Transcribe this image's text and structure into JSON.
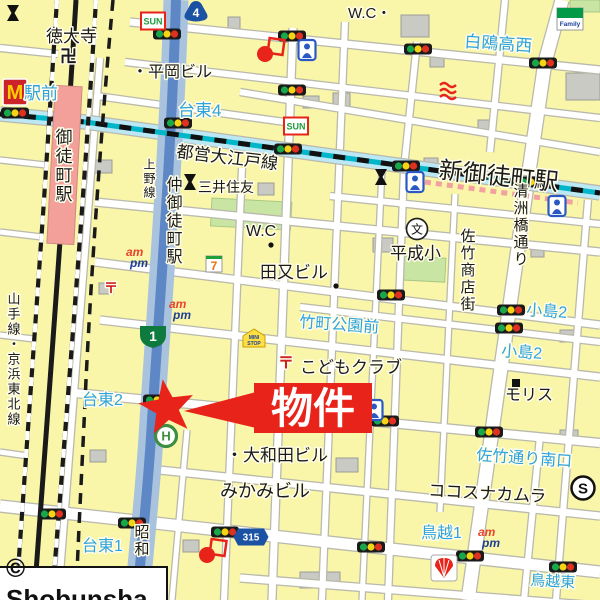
{
  "copyright": "© Shobunsha",
  "property_marker": {
    "label": "物件",
    "star": {
      "x": 167,
      "y": 408,
      "outer": 29,
      "inner": 12
    },
    "banner": {
      "x": 254,
      "y": 383,
      "w": 118,
      "h": 50
    },
    "pointer": [
      [
        256,
        392
      ],
      [
        256,
        428
      ],
      [
        184,
        411
      ]
    ]
  },
  "colors": {
    "block": "#FAF6A9",
    "street": "#FFFFFF",
    "casing": "#B9B9AC",
    "road_blue_outer": "#A9C3DE",
    "road_blue_core": "#5E87C6",
    "road_cyan": "#BCE7F5",
    "oedo_teal": "#00B6C9",
    "station_band": "#F3A0A0",
    "park": "#C9E5A3",
    "building": "#C9CAC4",
    "building_edge": "#9B9C96",
    "label_blue": "#2FA3DC",
    "label_red": "#CC2222",
    "red": "#E8231A",
    "rail": "#1A1A1A",
    "station_pink": "#F2A099",
    "shield_blue": "#1B52A3",
    "shield_green": "#0E7A3E"
  },
  "map": {
    "parks": [
      [
        212,
        198,
        80,
        28,
        3
      ],
      [
        404,
        256,
        42,
        24,
        3
      ],
      [
        570,
        0,
        30,
        12,
        0
      ]
    ],
    "buildings": [
      [
        401,
        15,
        28,
        22
      ],
      [
        430,
        55,
        14,
        12
      ],
      [
        566,
        73,
        34,
        27
      ],
      [
        303,
        96,
        16,
        12
      ],
      [
        478,
        120,
        18,
        13
      ],
      [
        94,
        160,
        18,
        13
      ],
      [
        258,
        183,
        16,
        12
      ],
      [
        424,
        158,
        14,
        11
      ],
      [
        531,
        246,
        13,
        11
      ],
      [
        373,
        238,
        20,
        14
      ],
      [
        99,
        283,
        14,
        11
      ],
      [
        560,
        330,
        16,
        12
      ],
      [
        336,
        458,
        22,
        14
      ],
      [
        183,
        540,
        16,
        12
      ],
      [
        300,
        572,
        40,
        16
      ],
      [
        90,
        450,
        16,
        12
      ],
      [
        560,
        430,
        18,
        12
      ],
      [
        228,
        17,
        12,
        17
      ],
      [
        333,
        93,
        17,
        17
      ]
    ],
    "streets": [
      {
        "pts": [
          [
            130,
            22
          ],
          [
            600,
            70
          ]
        ],
        "w": 7
      },
      {
        "pts": [
          [
            125,
            62
          ],
          [
            600,
            118
          ]
        ],
        "w": 6
      },
      {
        "pts": [
          [
            240,
            92
          ],
          [
            600,
            152
          ]
        ],
        "w": 6
      },
      {
        "pts": [
          [
            97,
            96
          ],
          [
            292,
            123
          ]
        ],
        "w": 6
      },
      {
        "pts": [
          [
            330,
            196
          ],
          [
            600,
            224
          ]
        ],
        "w": 6
      },
      {
        "pts": [
          [
            95,
            202
          ],
          [
            600,
            252
          ]
        ],
        "w": 7
      },
      {
        "pts": [
          [
            95,
            262
          ],
          [
            600,
            325
          ]
        ],
        "w": 7
      },
      {
        "pts": [
          [
            300,
            307
          ],
          [
            600,
            342
          ]
        ],
        "w": 6
      },
      {
        "pts": [
          [
            100,
            320
          ],
          [
            600,
            377
          ]
        ],
        "w": 7
      },
      {
        "pts": [
          [
            75,
            393
          ],
          [
            600,
            443
          ]
        ],
        "w": 8
      },
      {
        "pts": [
          [
            140,
            468
          ],
          [
            600,
            516
          ]
        ],
        "w": 7
      },
      {
        "pts": [
          [
            0,
            506
          ],
          [
            600,
            572
          ]
        ],
        "w": 11
      },
      {
        "pts": [
          [
            240,
            578
          ],
          [
            600,
            606
          ]
        ],
        "w": 7
      },
      {
        "pts": [
          [
            0,
            48
          ],
          [
            58,
            54
          ]
        ],
        "w": 6
      },
      {
        "pts": [
          [
            0,
            160
          ],
          [
            46,
            165
          ]
        ],
        "w": 5
      },
      {
        "pts": [
          [
            0,
            232
          ],
          [
            42,
            237
          ]
        ],
        "w": 5
      },
      {
        "pts": [
          [
            0,
            335
          ],
          [
            34,
            339
          ]
        ],
        "w": 5
      },
      {
        "pts": [
          [
            0,
            452
          ],
          [
            28,
            456
          ]
        ],
        "w": 5
      },
      {
        "pts": [
          [
            100,
            58
          ],
          [
            58,
            600
          ]
        ],
        "w": 6
      },
      {
        "pts": [
          [
            242,
            168
          ],
          [
            224,
            600
          ]
        ],
        "w": 6
      },
      {
        "pts": [
          [
            293,
            28
          ],
          [
            272,
            600
          ]
        ],
        "w": 7
      },
      {
        "pts": [
          [
            345,
            22
          ],
          [
            322,
            600
          ]
        ],
        "w": 6
      },
      {
        "pts": [
          [
            417,
            42
          ],
          [
            404,
            168
          ],
          [
            388,
            600
          ]
        ],
        "w": 6
      },
      {
        "pts": [
          [
            382,
            170
          ],
          [
            362,
            600
          ]
        ],
        "w": 5
      },
      {
        "pts": [
          [
            455,
            194
          ],
          [
            440,
            512
          ]
        ],
        "w": 5
      },
      {
        "pts": [
          [
            562,
            0
          ],
          [
            545,
            62
          ],
          [
            527,
            185
          ],
          [
            468,
            600
          ]
        ],
        "w": 13
      },
      {
        "pts": [
          [
            588,
            200
          ],
          [
            556,
            600
          ]
        ],
        "w": 6
      },
      {
        "pts": [
          [
            505,
            0
          ],
          [
            490,
            152
          ]
        ],
        "w": 6
      },
      {
        "pts": [
          [
            540,
            436
          ],
          [
            524,
            600
          ]
        ],
        "w": 6
      },
      {
        "pts": [
          [
            187,
            430
          ],
          [
            172,
            600
          ]
        ],
        "w": 5
      }
    ],
    "showa_road_path": "M176,0 C172,140 160,300 152,420 C149,480 142,540 137,600",
    "kasuga_road_pts": [
      [
        0,
        114
      ],
      [
        85,
        122
      ],
      [
        600,
        193
      ]
    ],
    "oedo_station_band": [
      [
        425,
        176
      ],
      [
        578,
        197
      ]
    ],
    "railways": {
      "jr_hatched": [
        "M57,0 C45,200 28,420 16,600",
        "M96,0 C84,200 66,420 52,600"
      ],
      "jr_solid": "M76,0 C64,200 47,420 34,600",
      "underground_dashed": "M113,0 C102,120 92,260 86,380 C82,470 78,540 76,600"
    },
    "station_rect": {
      "x": 51,
      "y": 86,
      "w": 27,
      "h": 158,
      "rot": 3
    },
    "traffic_lights": [
      [
        15,
        113
      ],
      [
        167,
        34
      ],
      [
        178,
        123
      ],
      [
        292,
        36
      ],
      [
        292,
        90
      ],
      [
        288,
        149
      ],
      [
        418,
        49
      ],
      [
        543,
        63
      ],
      [
        406,
        166
      ],
      [
        531,
        182
      ],
      [
        391,
        295
      ],
      [
        511,
        310
      ],
      [
        509,
        328
      ],
      [
        157,
        400
      ],
      [
        233,
        408
      ],
      [
        385,
        421
      ],
      [
        489,
        432
      ],
      [
        52,
        514
      ],
      [
        132,
        523
      ],
      [
        225,
        532
      ],
      [
        371,
        547
      ],
      [
        470,
        556
      ],
      [
        563,
        567
      ]
    ],
    "shields": [
      {
        "name": "national-route-shield",
        "kind": "national",
        "label": "4",
        "x": 196,
        "y": 12
      },
      {
        "name": "expressway-route-shield",
        "kind": "shuto",
        "label": "1",
        "x": 153,
        "y": 336
      },
      {
        "name": "prefectural-route-shield",
        "kind": "pref",
        "label": "315",
        "x": 251,
        "y": 537
      }
    ],
    "icons": [
      {
        "name": "mcdonalds-icon",
        "kind": "mcdonalds",
        "x": 15,
        "y": 92,
        "label": "M"
      },
      {
        "name": "pachinko-sun-sign-icon",
        "kind": "sun",
        "x": 153,
        "y": 21,
        "label": "SUN"
      },
      {
        "name": "pachinko-sun-sign-icon",
        "kind": "sun",
        "x": 296,
        "y": 126,
        "label": "SUN"
      },
      {
        "name": "ampm-store-icon",
        "kind": "ampm",
        "x": 134,
        "y": 256,
        "label": "am pm"
      },
      {
        "name": "ampm-store-icon",
        "kind": "ampm",
        "x": 177,
        "y": 308,
        "label": "am pm"
      },
      {
        "name": "ampm-store-icon",
        "kind": "ampm",
        "x": 486,
        "y": 536,
        "label": "am pm"
      },
      {
        "name": "seven-eleven-icon",
        "kind": "seven",
        "x": 214,
        "y": 264,
        "label": "7"
      },
      {
        "name": "ministop-icon",
        "kind": "ministop",
        "x": 254,
        "y": 339,
        "label": "MINI STOP"
      },
      {
        "name": "familymart-icon",
        "kind": "familymart",
        "x": 570,
        "y": 19,
        "label": "Family"
      },
      {
        "name": "shell-gas-station-icon",
        "kind": "shell",
        "x": 444,
        "y": 568
      },
      {
        "name": "hibiya-line-entrance-icon",
        "kind": "hibiya",
        "x": 166,
        "y": 436,
        "label": "H"
      },
      {
        "name": "school-icon",
        "kind": "school",
        "x": 417,
        "y": 229,
        "label": "文"
      },
      {
        "name": "bank-icon",
        "kind": "bank",
        "x": 190,
        "y": 182
      },
      {
        "name": "bank-icon",
        "kind": "bank",
        "x": 381,
        "y": 177
      },
      {
        "name": "bank-icon",
        "kind": "bank",
        "x": 13,
        "y": 13
      },
      {
        "name": "supermarket-icon",
        "kind": "scircle",
        "x": 583,
        "y": 488,
        "label": "S"
      },
      {
        "name": "fire-station-icon",
        "kind": "fire",
        "x": 448,
        "y": 92
      },
      {
        "name": "police-box-icon",
        "kind": "koban",
        "x": 307,
        "y": 50
      },
      {
        "name": "police-box-icon",
        "kind": "koban",
        "x": 374,
        "y": 410
      },
      {
        "name": "subway-entrance-icon",
        "kind": "koban",
        "x": 415,
        "y": 182
      },
      {
        "name": "subway-entrance-icon",
        "kind": "koban",
        "x": 557,
        "y": 206
      },
      {
        "name": "poi-marker-icon",
        "kind": "redpoi",
        "x": 269,
        "y": 50
      },
      {
        "name": "poi-marker-icon",
        "kind": "redpoi",
        "x": 211,
        "y": 551
      },
      {
        "name": "building-marker-icon",
        "kind": "blacksquare",
        "x": 516,
        "y": 383
      },
      {
        "name": "poi-dot-icon",
        "kind": "dot",
        "x": 271,
        "y": 245
      },
      {
        "name": "poi-dot-icon",
        "kind": "dot",
        "x": 336,
        "y": 286
      }
    ],
    "labels": [
      {
        "t": "徳大寺",
        "x": 46,
        "y": 42,
        "s": 17
      },
      {
        "t": "卍",
        "x": 60,
        "y": 62,
        "s": 17,
        "b": 1
      },
      {
        "t": "・平岡ビル",
        "x": 132,
        "y": 77,
        "s": 16
      },
      {
        "t": "W.C・",
        "x": 348,
        "y": 18,
        "s": 15
      },
      {
        "t": "駅前",
        "x": 24,
        "y": 99,
        "s": 17,
        "c": "blue"
      },
      {
        "t": "台東4",
        "x": 178,
        "y": 116,
        "s": 17,
        "c": "blue"
      },
      {
        "t": "白鴎高西",
        "x": 464,
        "y": 47,
        "s": 17,
        "c": "blue",
        "r": 4
      },
      {
        "t": "都営大江戸線",
        "x": 176,
        "y": 157,
        "s": 17,
        "r": 7
      },
      {
        "t": "新御徒町駅",
        "x": 438,
        "y": 178,
        "s": 24,
        "r": 6
      },
      {
        "t": "三井住友",
        "x": 198,
        "y": 192,
        "s": 14
      },
      {
        "t": "W.C",
        "x": 246,
        "y": 236,
        "s": 16
      },
      {
        "t": "田又ビル",
        "x": 260,
        "y": 278,
        "s": 17
      },
      {
        "t": "平成小",
        "x": 390,
        "y": 259,
        "s": 17
      },
      {
        "t": "竹町公園前",
        "x": 299,
        "y": 327,
        "s": 16,
        "c": "blue",
        "r": 4
      },
      {
        "t": "小島2",
        "x": 526,
        "y": 315,
        "s": 16,
        "c": "blue",
        "r": 4
      },
      {
        "t": "小島2",
        "x": 501,
        "y": 356,
        "s": 16,
        "c": "blue",
        "r": 4
      },
      {
        "t": "〒",
        "x": 104,
        "y": 293,
        "s": 14,
        "c": "red",
        "b": 1
      },
      {
        "t": "〒",
        "x": 278,
        "y": 368,
        "s": 16,
        "c": "red",
        "b": 1
      },
      {
        "t": "こどもクラブ",
        "x": 300,
        "y": 373,
        "s": 17
      },
      {
        "t": "モリス",
        "x": 505,
        "y": 400,
        "s": 16
      },
      {
        "t": "台東2",
        "x": 82,
        "y": 405,
        "s": 16,
        "c": "blue"
      },
      {
        "t": "・大和田ビル",
        "x": 226,
        "y": 461,
        "s": 17
      },
      {
        "t": "みかみビル",
        "x": 220,
        "y": 497,
        "s": 18
      },
      {
        "t": "佐竹通り南口",
        "x": 476,
        "y": 460,
        "s": 16,
        "c": "blue",
        "r": 4
      },
      {
        "t": "ココスナカムラ",
        "x": 428,
        "y": 496,
        "s": 17,
        "r": 3
      },
      {
        "t": "鳥越1",
        "x": 421,
        "y": 538,
        "s": 16,
        "c": "blue"
      },
      {
        "t": "台東1",
        "x": 82,
        "y": 551,
        "s": 16,
        "c": "blue"
      },
      {
        "t": "鳥越東",
        "x": 530,
        "y": 585,
        "s": 15,
        "c": "blue",
        "r": 3
      },
      {
        "t": "昭和",
        "x": 141,
        "y": 524,
        "s": 15,
        "v": 1
      },
      {
        "t": "山手線・京浜東北線",
        "x": 13,
        "y": 292,
        "s": 13,
        "v": 1
      },
      {
        "t": "御徒町駅",
        "x": 62,
        "y": 128,
        "s": 17,
        "v": 1
      },
      {
        "t": "仲御徒町駅",
        "x": 172,
        "y": 176,
        "s": 16,
        "v": 1
      },
      {
        "t": "上野線",
        "x": 149,
        "y": 158,
        "s": 12,
        "v": 1
      },
      {
        "t": "清洲橋通り",
        "x": 520,
        "y": 183,
        "s": 15,
        "v": 1
      },
      {
        "t": "佐竹商店街",
        "x": 467,
        "y": 228,
        "s": 15,
        "v": 1
      }
    ]
  }
}
